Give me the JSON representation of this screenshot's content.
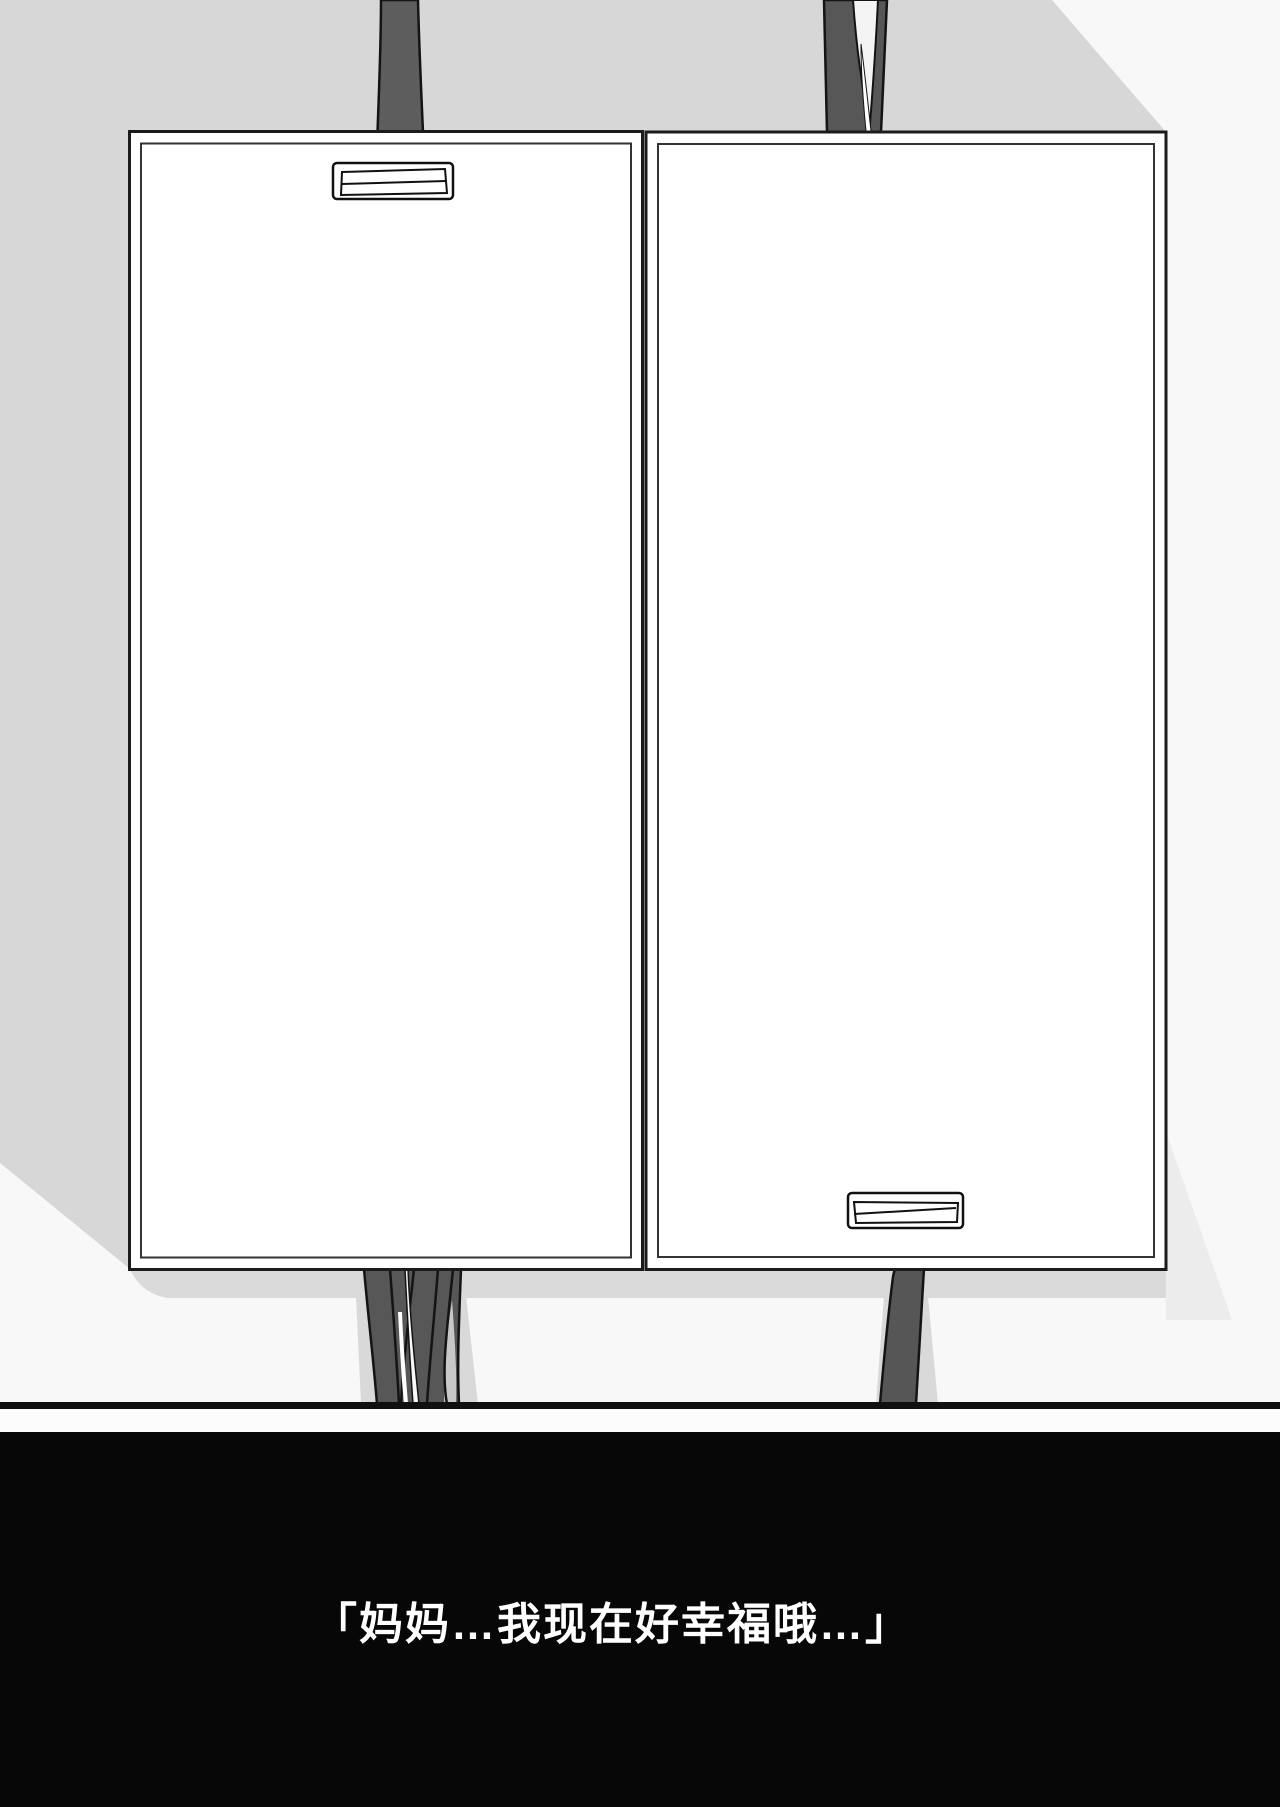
{
  "page_type": "comic-page",
  "caption": {
    "text": "「妈妈…我现在好幸福哦…」"
  },
  "colors": {
    "page_background": "#f8f8f8",
    "backdrop_gray": "#d7d7d7",
    "shadow_gray": "#dadada",
    "soft_shadow_gray": "#ececec",
    "strap_gray": "#575757",
    "outline_black": "#141414",
    "panel_white": "#ffffff",
    "floor_line_black": "#101010",
    "caption_band_black": "#070707",
    "caption_text_white": "#ffffff"
  }
}
